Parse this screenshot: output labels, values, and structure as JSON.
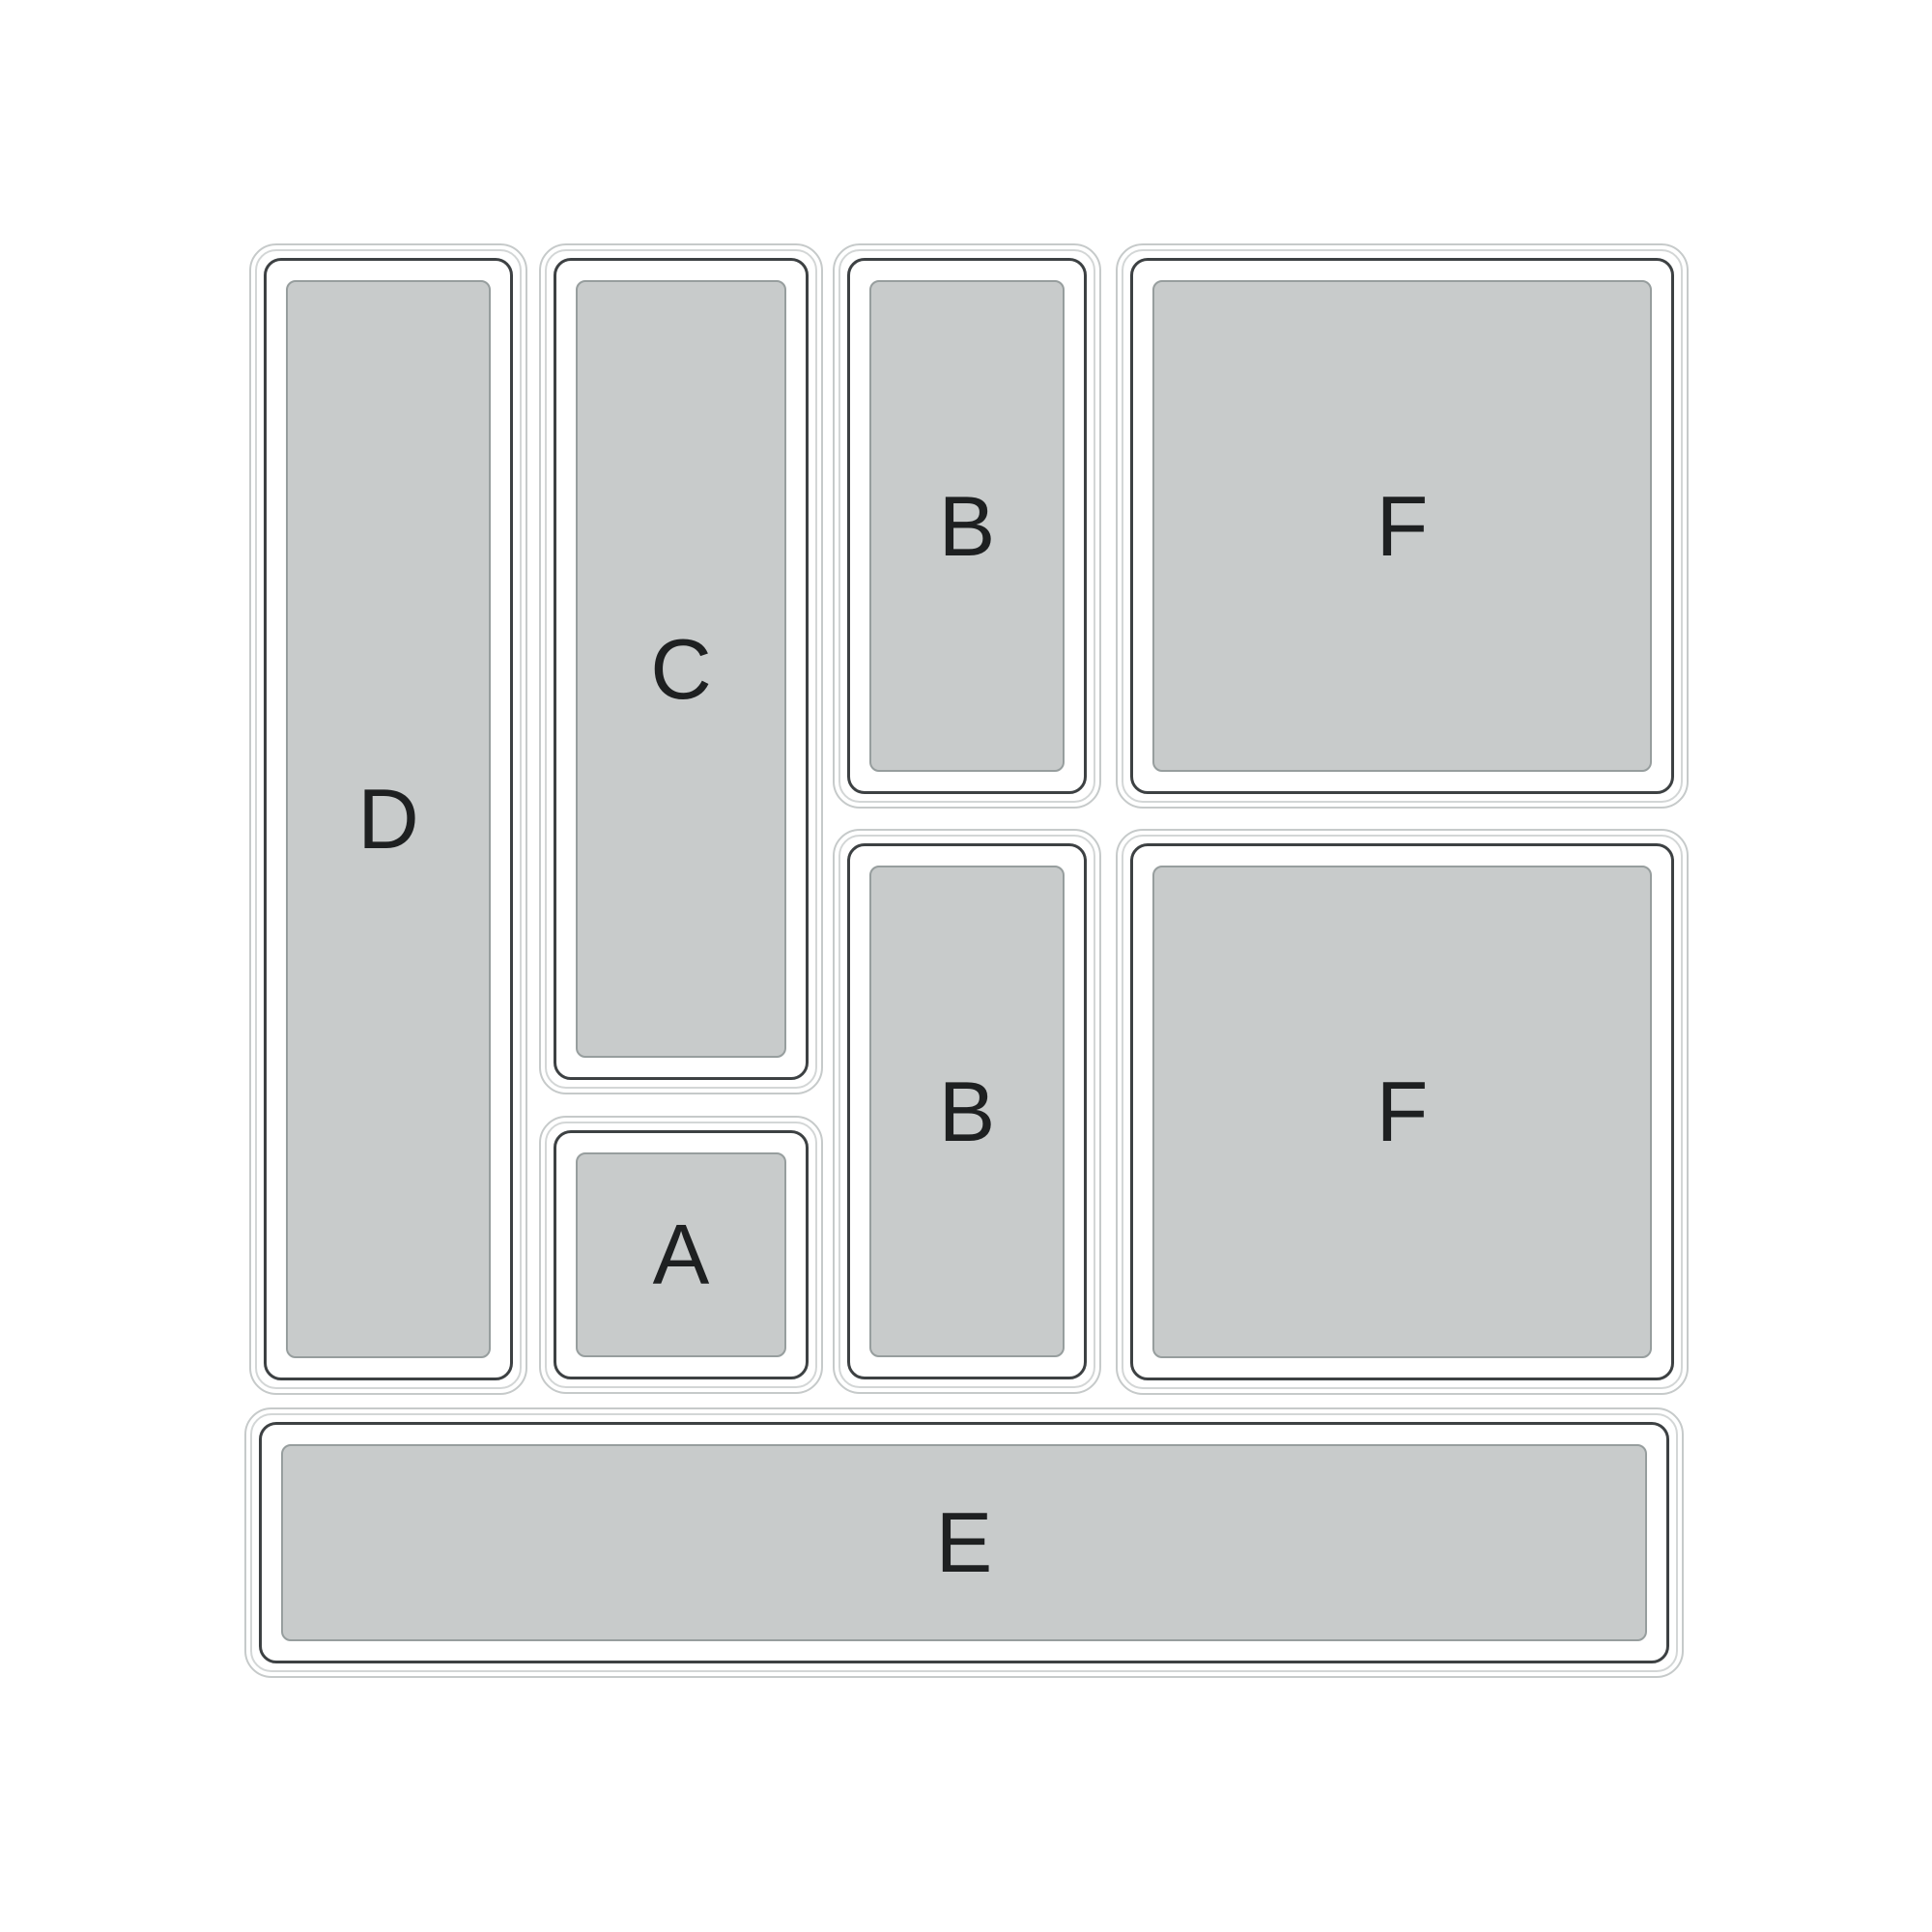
{
  "diagram": {
    "compartments": [
      {
        "key": "D",
        "label": "D"
      },
      {
        "key": "C",
        "label": "C"
      },
      {
        "key": "A",
        "label": "A"
      },
      {
        "key": "B-top",
        "label": "B"
      },
      {
        "key": "B-bottom",
        "label": "B"
      },
      {
        "key": "F-top",
        "label": "F"
      },
      {
        "key": "F-bottom",
        "label": "F"
      },
      {
        "key": "E",
        "label": "E"
      }
    ],
    "colors": {
      "background": "#ffffff",
      "tray_fill": "#c8cbcb",
      "tray_fill_stroke": "#979e9e",
      "inner_wall_stroke": "#3d4143",
      "outer_wall_stroke": "#c6caca",
      "label_text": "#1e2021"
    }
  }
}
